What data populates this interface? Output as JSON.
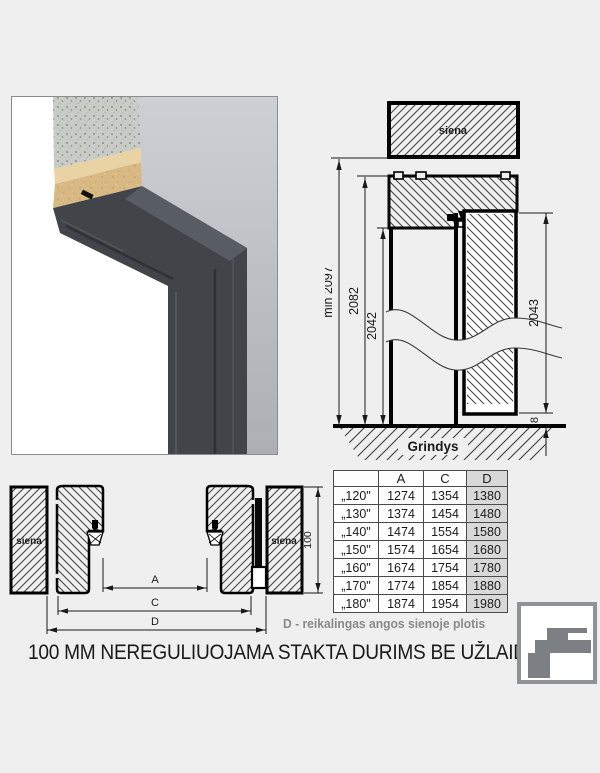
{
  "colors": {
    "background": "#f0efef",
    "drawing_line": "#000000",
    "note_gray": "#898989",
    "table_highlight_col": "#d8d8d8",
    "frame_dark": "#41454a",
    "wall_gray": "#bfc3c7",
    "concrete_gray": "#c8cbc6",
    "chipboard_tan": "#d9b983",
    "logo_gray": "#7c7f83"
  },
  "vertical_section": {
    "wall_label": "siena",
    "floor_label": "Grindys",
    "dim_total_min": "min 2097",
    "dim_frame_outer": "2082",
    "dim_opening": "2042",
    "dim_door": "2043",
    "dim_floor_gap": "8"
  },
  "horizontal_section": {
    "wall_label_left": "siena",
    "wall_label_right": "siena",
    "dim_frame_depth": "100",
    "dim_a": "A",
    "dim_c": "C",
    "dim_d": "D"
  },
  "size_table": {
    "col_headers": {
      "size": "",
      "a": "A",
      "c": "C",
      "d": "D"
    },
    "rows": [
      {
        "size": "„120\"",
        "a": "1274",
        "c": "1354",
        "d": "1380"
      },
      {
        "size": "„130\"",
        "a": "1374",
        "c": "1454",
        "d": "1480"
      },
      {
        "size": "„140\"",
        "a": "1474",
        "c": "1554",
        "d": "1580"
      },
      {
        "size": "„150\"",
        "a": "1574",
        "c": "1654",
        "d": "1680"
      },
      {
        "size": "„160\"",
        "a": "1674",
        "c": "1754",
        "d": "1780"
      },
      {
        "size": "„170\"",
        "a": "1774",
        "c": "1854",
        "d": "1880"
      },
      {
        "size": "„180\"",
        "a": "1874",
        "c": "1954",
        "d": "1980"
      }
    ]
  },
  "note": "D - reikalingas angos sienoje plotis",
  "title": "100 MM NEREGULIUOJAMA STAKTA DURIMS BE UŽLAIDOS",
  "icons": {
    "logo": "door-frame-profile-logo"
  }
}
